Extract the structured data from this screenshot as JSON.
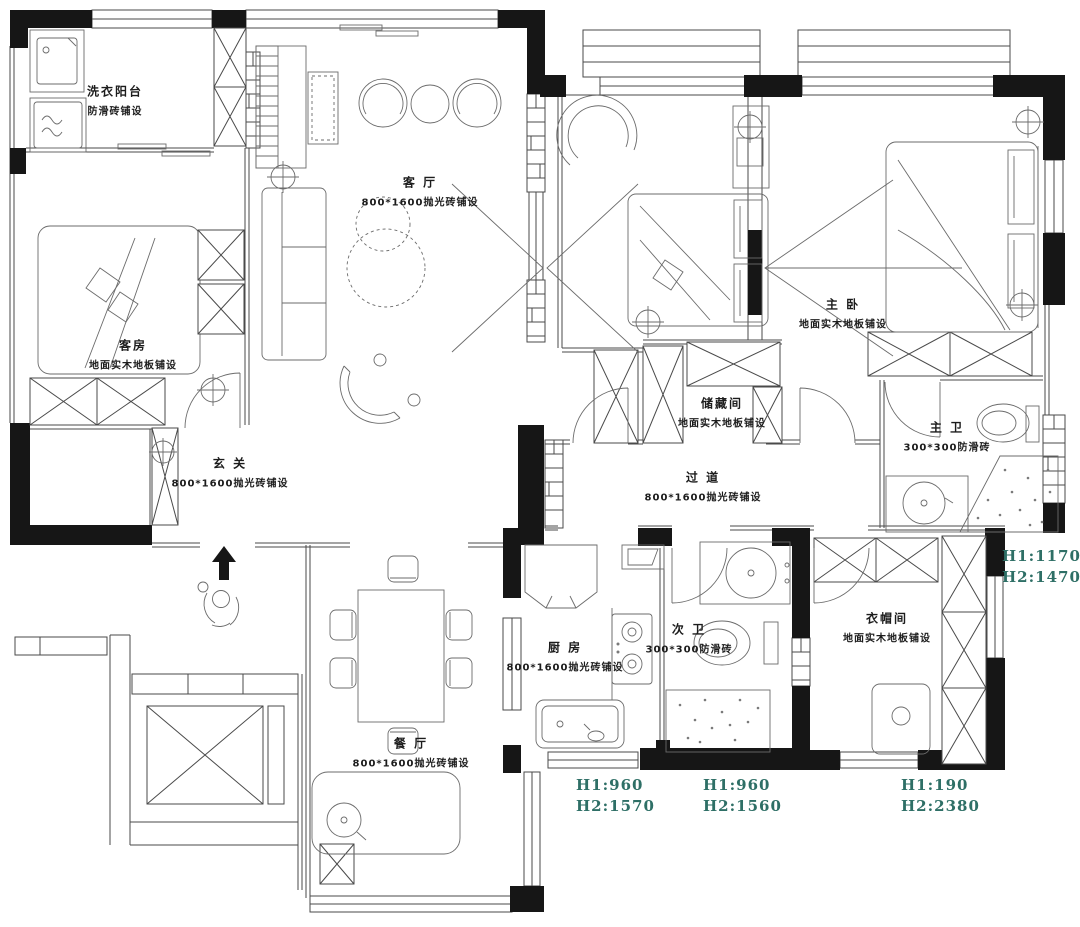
{
  "plan": {
    "rooms": [
      {
        "id": "laundry-balcony",
        "name": "洗衣阳台",
        "finish": "防滑砖铺设"
      },
      {
        "id": "living-room",
        "name": "客 厅",
        "finish": "800*1600抛光砖铺设"
      },
      {
        "id": "guest-room",
        "name": "客房",
        "finish": "地面实木地板铺设"
      },
      {
        "id": "entryway",
        "name": "玄 关",
        "finish": "800*1600抛光砖铺设"
      },
      {
        "id": "master-bedroom",
        "name": "主 卧",
        "finish": "地面实木地板铺设"
      },
      {
        "id": "storage-room",
        "name": "储藏间",
        "finish": "地面实木地板铺设"
      },
      {
        "id": "hallway",
        "name": "过 道",
        "finish": "800*1600抛光砖铺设"
      },
      {
        "id": "master-bathroom",
        "name": "主 卫",
        "finish": "300*300防滑砖"
      },
      {
        "id": "kitchen",
        "name": "厨 房",
        "finish": "800*1600抛光砖铺设"
      },
      {
        "id": "second-bathroom",
        "name": "次 卫",
        "finish": "300*300防滑砖"
      },
      {
        "id": "cloakroom",
        "name": "衣帽间",
        "finish": "地面实木地板铺设"
      },
      {
        "id": "dining-room",
        "name": "餐 厅",
        "finish": "800*1600抛光砖铺设"
      }
    ],
    "dimensions": [
      {
        "line1": "H1:1170",
        "line2": "H2:1470"
      },
      {
        "line1": "H1:960",
        "line2": "H2:1570"
      },
      {
        "line1": "H1:960",
        "line2": "H2:1560"
      },
      {
        "line1": "H1:190",
        "line2": "H2:2380"
      }
    ],
    "colors": {
      "wall": "#161616",
      "line": "#4a4a4a",
      "furniture": "#6b6b6b",
      "dimension": "#2e6f66",
      "background": "#ffffff"
    }
  }
}
